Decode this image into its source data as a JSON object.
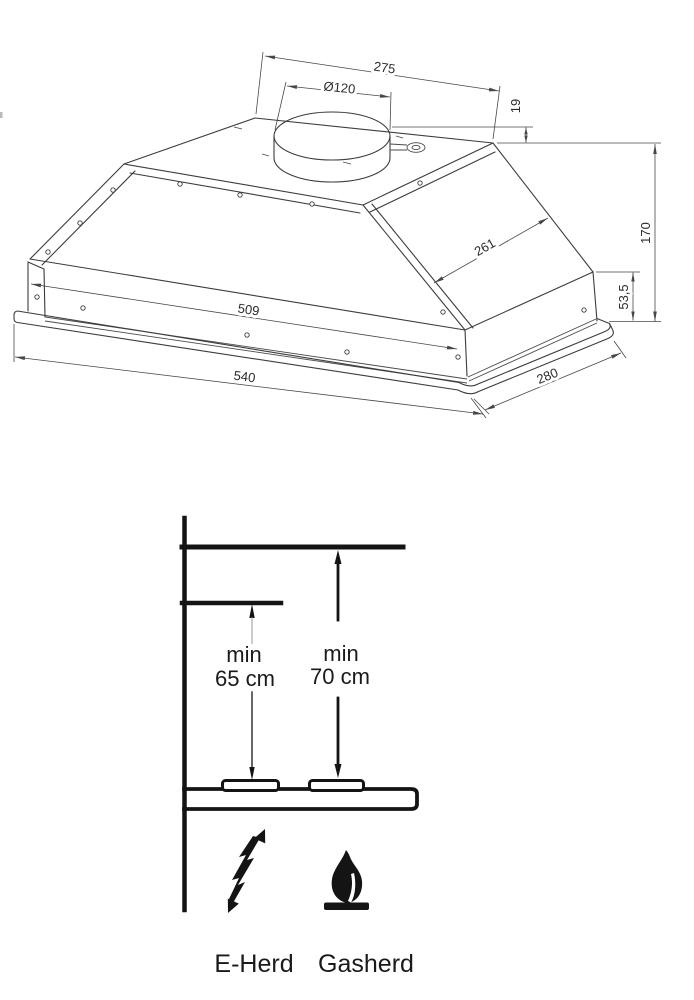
{
  "hood_diagram": {
    "dims": {
      "top_width": "275",
      "duct_diameter": "Ø120",
      "collar_height": "19",
      "side_slant": "261",
      "total_height": "170",
      "lower_height": "53,5",
      "body_width": "509",
      "base_width": "540",
      "base_depth": "280"
    }
  },
  "installation_diagram": {
    "electric": {
      "min_line1": "min",
      "min_line2": "65 cm",
      "label": "E-Herd"
    },
    "gas": {
      "min_line1": "min",
      "min_line2": "70 cm",
      "label": "Gasherd"
    }
  },
  "colors": {
    "drawing_line": "#3c3c3c",
    "dimension_line": "#474747",
    "ink": "#141414",
    "background": "#ffffff"
  }
}
